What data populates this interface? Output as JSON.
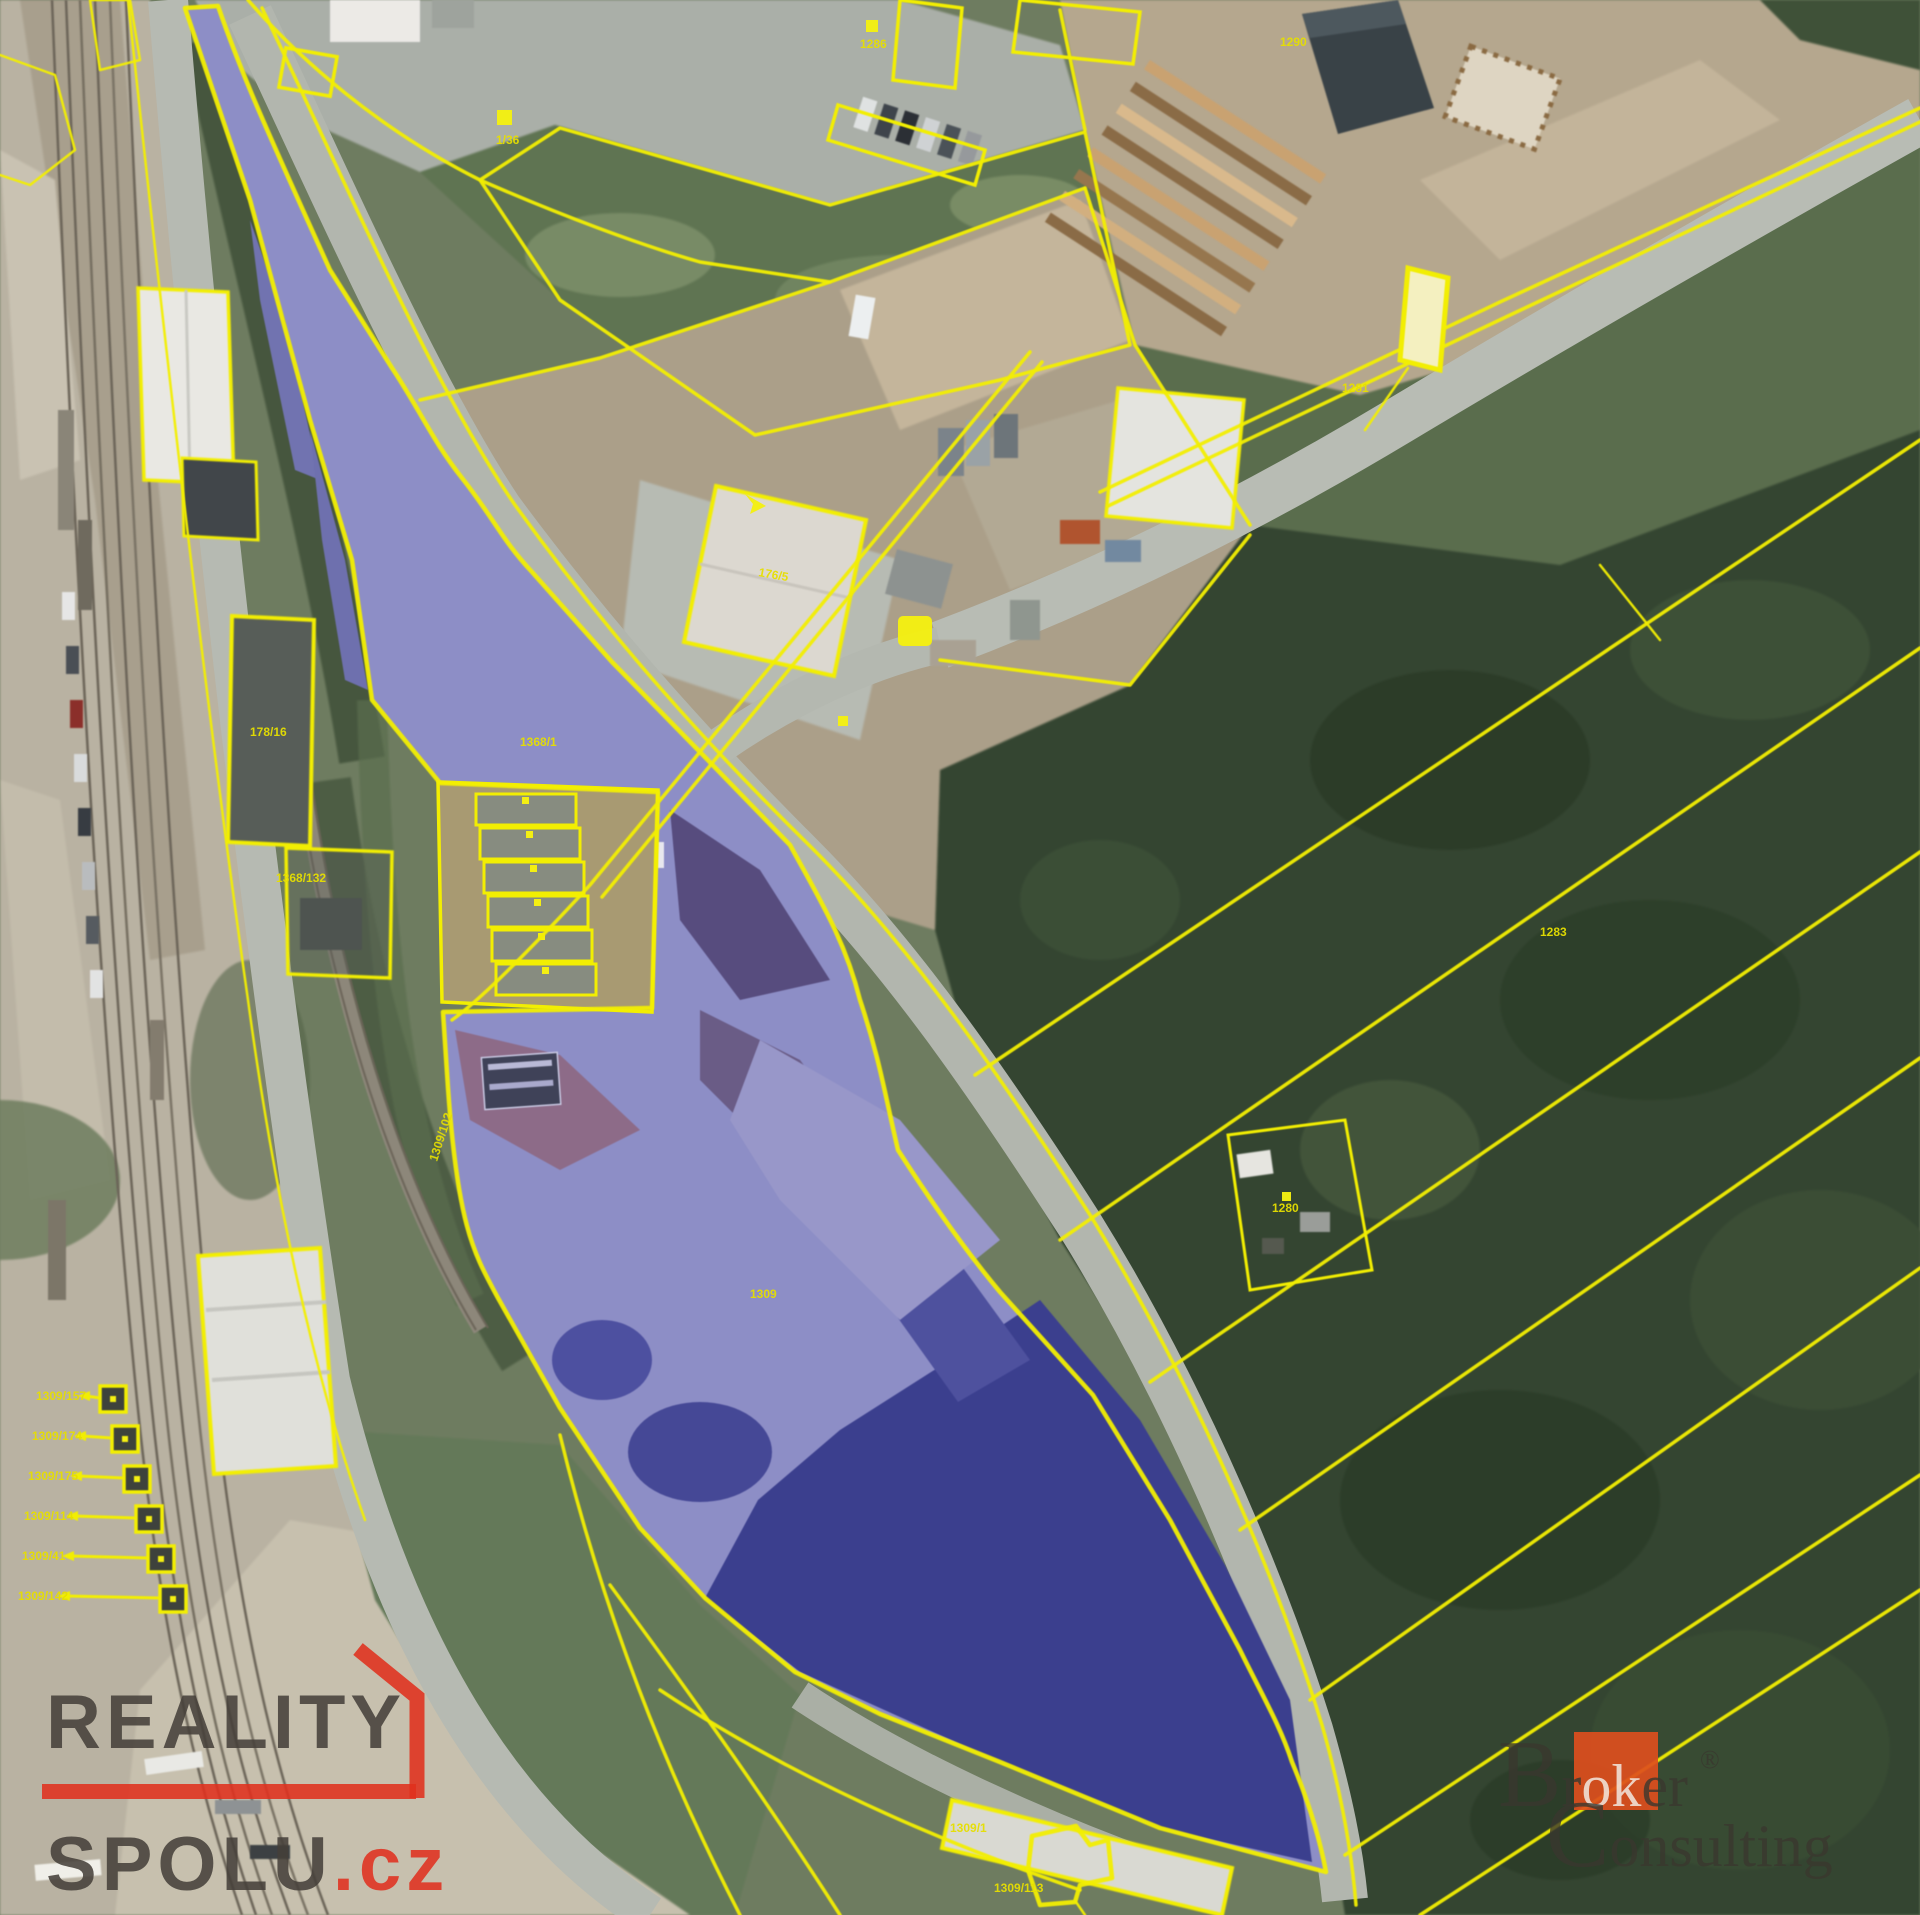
{
  "map": {
    "labels": [
      {
        "text": "1/36"
      },
      {
        "text": "1286"
      },
      {
        "text": "1290"
      },
      {
        "text": "178/16"
      },
      {
        "text": "1368/132"
      },
      {
        "text": "176/5"
      },
      {
        "text": "1368/1"
      },
      {
        "text": "1309"
      },
      {
        "text": "1283"
      },
      {
        "text": "1280"
      },
      {
        "text": "1309/102"
      },
      {
        "text": "1309/157"
      },
      {
        "text": "1309/174"
      },
      {
        "text": "1309/175"
      },
      {
        "text": "1309/114"
      },
      {
        "text": "1309/41"
      },
      {
        "text": "1309/142"
      },
      {
        "text": "1309/1"
      },
      {
        "text": "1309/113"
      },
      {
        "text": "1281"
      }
    ]
  },
  "theme": {
    "cadastral_line": "#f2ee02",
    "label_color": "#e6df00",
    "marker_fill": "#f4ef12",
    "highlight_fill": "#8d8ec6",
    "highlight_dark": "#3b3f8e",
    "rs_text": "#45403a",
    "rs_red": "#e0301e",
    "bc_text": "#3a382f",
    "bc_orange": "#dd4e1d",
    "bc_white": "#f5f3ee"
  },
  "watermarks": {
    "reality_spolu": {
      "word1": "REALITY",
      "word2": "SPOLU",
      "suffix": ".cz"
    },
    "broker_consulting": {
      "b": "B",
      "r": "r",
      "ok": "ok",
      "er": "er",
      "registered": "®",
      "c": "C",
      "onsulting": "onsulting"
    }
  }
}
